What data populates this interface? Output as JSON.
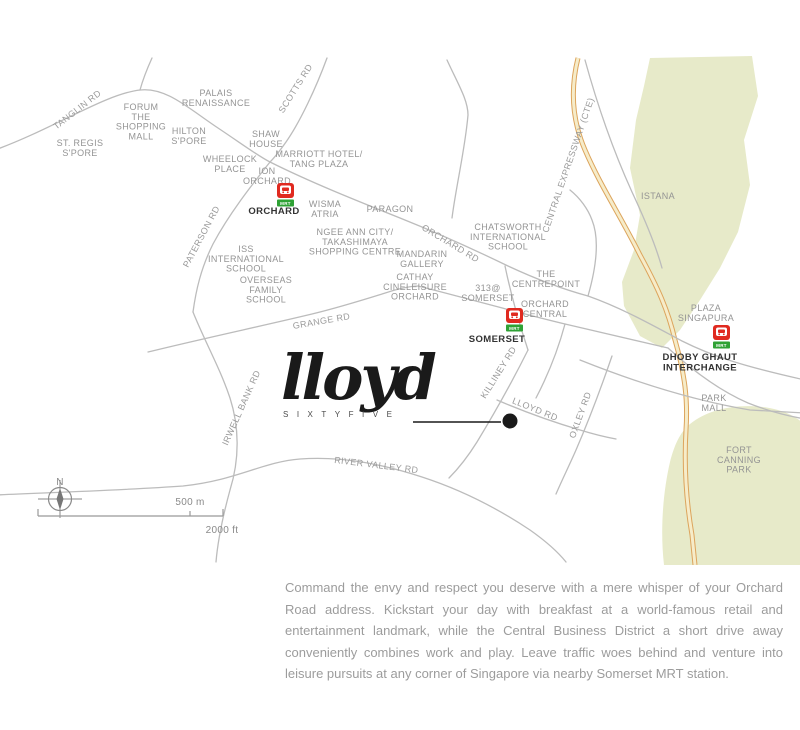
{
  "logo": {
    "script": "lloyd",
    "subtitle": "SIXTYFIVE"
  },
  "legend": {
    "north": "N",
    "scale_top": "500 m",
    "scale_bottom": "2000 ft"
  },
  "description": {
    "text": "Command the envy and respect you deserve with a mere whisper of your Orchard Road address. Kickstart your day with breakfast at a world-famous retail and entertainment landmark, while the Central Business District a short drive away conveniently combines work and play. Leave traffic woes behind and venture into leisure pursuits at any corner of Singapore via nearby Somerset MRT station."
  },
  "map": {
    "colors": {
      "road": "#bcbcbc",
      "place_label": "#949494",
      "station_label": "#333333",
      "mrt_red": "#e02a20",
      "mrt_green": "#2fa235",
      "expressway_fill": "#f6ecc9",
      "expressway_casing": "#dca45c",
      "park_green": "#e7eac9",
      "marker_black": "#1a1a1a"
    },
    "mrt_badge_text": "MRT",
    "labels": {
      "places": [
        {
          "name": "st-regis-spore",
          "x": 80,
          "y": 146,
          "lines": [
            "ST. REGIS",
            "S'PORE"
          ]
        },
        {
          "name": "forum-the-shopping-mall",
          "x": 141,
          "y": 110,
          "lines": [
            "FORUM",
            "THE",
            "SHOPPING",
            "MALL"
          ]
        },
        {
          "name": "palais-renaissance",
          "x": 216,
          "y": 96,
          "lines": [
            "PALAIS",
            "RENAISSANCE"
          ]
        },
        {
          "name": "hilton-spore",
          "x": 189,
          "y": 134,
          "lines": [
            "HILTON",
            "S'PORE"
          ]
        },
        {
          "name": "shaw-house",
          "x": 266,
          "y": 137,
          "lines": [
            "SHAW",
            "HOUSE"
          ]
        },
        {
          "name": "wheelock-place",
          "x": 230,
          "y": 162,
          "lines": [
            "WHEELOCK",
            "PLACE"
          ]
        },
        {
          "name": "marriott-hotel-tang-plaza",
          "x": 319,
          "y": 157,
          "lines": [
            "MARRIOTT HOTEL/",
            "TANG PLAZA"
          ]
        },
        {
          "name": "ion-orchard",
          "x": 267,
          "y": 174,
          "lines": [
            "ION",
            "ORCHARD"
          ]
        },
        {
          "name": "wisma-atria",
          "x": 325,
          "y": 207,
          "lines": [
            "WISMA",
            "ATRIA"
          ]
        },
        {
          "name": "paragon",
          "x": 390,
          "y": 212,
          "lines": [
            "PARAGON"
          ]
        },
        {
          "name": "ngee-ann-city-takashimaya",
          "x": 355,
          "y": 235,
          "lines": [
            "NGEE ANN CITY/",
            "TAKASHIMAYA",
            "SHOPPING CENTRE"
          ]
        },
        {
          "name": "mandarin-gallery",
          "x": 422,
          "y": 257,
          "lines": [
            "MANDARIN",
            "GALLERY"
          ]
        },
        {
          "name": "cathay-cineleisure-orchard",
          "x": 415,
          "y": 280,
          "lines": [
            "CATHAY",
            "CINELEISURE",
            "ORCHARD"
          ]
        },
        {
          "name": "iss-international-school",
          "x": 246,
          "y": 252,
          "lines": [
            "ISS",
            "INTERNATIONAL",
            "SCHOOL"
          ]
        },
        {
          "name": "overseas-family-school",
          "x": 266,
          "y": 283,
          "lines": [
            "OVERSEAS",
            "FAMILY",
            "SCHOOL"
          ]
        },
        {
          "name": "chatsworth-international-school",
          "x": 508,
          "y": 230,
          "lines": [
            "CHATSWORTH",
            "INTERNATIONAL",
            "SCHOOL"
          ]
        },
        {
          "name": "the-centrepoint",
          "x": 546,
          "y": 277,
          "lines": [
            "THE",
            "CENTREPOINT"
          ]
        },
        {
          "name": "313-somerset",
          "x": 488,
          "y": 291,
          "lines": [
            "313@",
            "SOMERSET"
          ]
        },
        {
          "name": "orchard-central",
          "x": 545,
          "y": 307,
          "lines": [
            "ORCHARD",
            "CENTRAL"
          ]
        },
        {
          "name": "istana",
          "x": 658,
          "y": 199,
          "lines": [
            "ISTANA"
          ]
        },
        {
          "name": "plaza-singapura",
          "x": 706,
          "y": 311,
          "lines": [
            "PLAZA",
            "SINGAPURA"
          ]
        },
        {
          "name": "park-mall",
          "x": 714,
          "y": 401,
          "lines": [
            "PARK",
            "MALL"
          ]
        },
        {
          "name": "fort-canning-park",
          "x": 739,
          "y": 453,
          "lines": [
            "FORT",
            "CANNING",
            "PARK"
          ]
        }
      ],
      "roads": [
        {
          "name": "tanglin-rd",
          "x": 79,
          "y": 112,
          "rotate": -38,
          "text": "TANGLIN RD"
        },
        {
          "name": "scotts-rd",
          "x": 298,
          "y": 90,
          "rotate": -58,
          "text": "SCOTTS RD"
        },
        {
          "name": "paterson-rd",
          "x": 204,
          "y": 238,
          "rotate": -62,
          "text": "PATERSON RD"
        },
        {
          "name": "orchard-rd",
          "x": 449,
          "y": 246,
          "rotate": 31,
          "text": "ORCHARD RD"
        },
        {
          "name": "grange-rd",
          "x": 322,
          "y": 324,
          "rotate": -10,
          "text": "GRANGE RD"
        },
        {
          "name": "irwell-bank-rd",
          "x": 244,
          "y": 409,
          "rotate": -66,
          "text": "IRWELL BANK RD"
        },
        {
          "name": "killiney-rd",
          "x": 501,
          "y": 374,
          "rotate": -58,
          "text": "KILLINEY RD"
        },
        {
          "name": "lloyd-rd",
          "x": 534,
          "y": 412,
          "rotate": 22,
          "text": "LLOYD RD"
        },
        {
          "name": "oxley-rd",
          "x": 583,
          "y": 416,
          "rotate": -70,
          "text": "OXLEY RD"
        },
        {
          "name": "river-valley-rd",
          "x": 376,
          "y": 468,
          "rotate": 7,
          "text": "RIVER VALLEY RD"
        },
        {
          "name": "central-expressway-cte",
          "x": 571,
          "y": 166,
          "rotate": -71,
          "text": "CENTRAL EXPRESSWAY (CTE)"
        }
      ]
    },
    "stations": [
      {
        "name": "orchard",
        "icon_x": 277,
        "icon_y": 183,
        "label_x": 274,
        "label_y": 214,
        "lines": [
          "ORCHARD"
        ]
      },
      {
        "name": "somerset",
        "icon_x": 506,
        "icon_y": 308,
        "label_x": 497,
        "label_y": 342,
        "lines": [
          "SOMERSET"
        ]
      },
      {
        "name": "dhoby-ghaut",
        "icon_x": 713,
        "icon_y": 325,
        "label_x": 700,
        "label_y": 360,
        "lines": [
          "DHOBY GHAUT",
          "INTERCHANGE"
        ]
      }
    ]
  }
}
